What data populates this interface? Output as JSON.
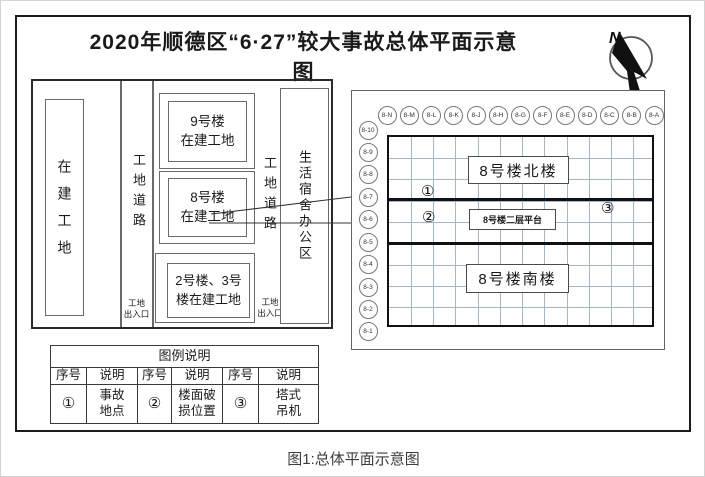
{
  "page": {
    "title": "2020年顺德区“6·27”较大事故总体平面示意图",
    "caption": "图1:总体平面示意图",
    "compass_label": "N"
  },
  "site_plan": {
    "construction_site": "在建工地",
    "road1": "工地道路",
    "road2": "工地道路",
    "gate1": "工地\n出入口",
    "gate2": "工地\n出入口",
    "building9": "9号楼\n在建工地",
    "building8": "8号楼\n在建工地",
    "building23": "2号楼、3号\n楼在建工地",
    "living_area": "生活宿舍办公区"
  },
  "detail_panel": {
    "north_building": "8号楼北楼",
    "platform": "8号楼二层平台",
    "south_building": "8号楼南楼",
    "marker1": "①",
    "marker2": "②",
    "marker3": "③",
    "col_axes": [
      "8-N",
      "8-M",
      "8-L",
      "8-K",
      "8-J",
      "8-H",
      "8-G",
      "8-F",
      "8-E",
      "8-D",
      "8-C",
      "8-B",
      "8-A"
    ],
    "row_axes": [
      "8-10",
      "8-9",
      "8-8",
      "8-7",
      "8-6",
      "8-5",
      "8-4",
      "8-3",
      "8-2",
      "8-1"
    ],
    "grid_color": "#9fb6da"
  },
  "legend": {
    "title": "图例说明",
    "headers": [
      "序号",
      "说明",
      "序号",
      "说明",
      "序号",
      "说明"
    ],
    "row": [
      "①",
      "事故\n地点",
      "②",
      "楼面破\n损位置",
      "③",
      "塔式\n吊机"
    ]
  }
}
